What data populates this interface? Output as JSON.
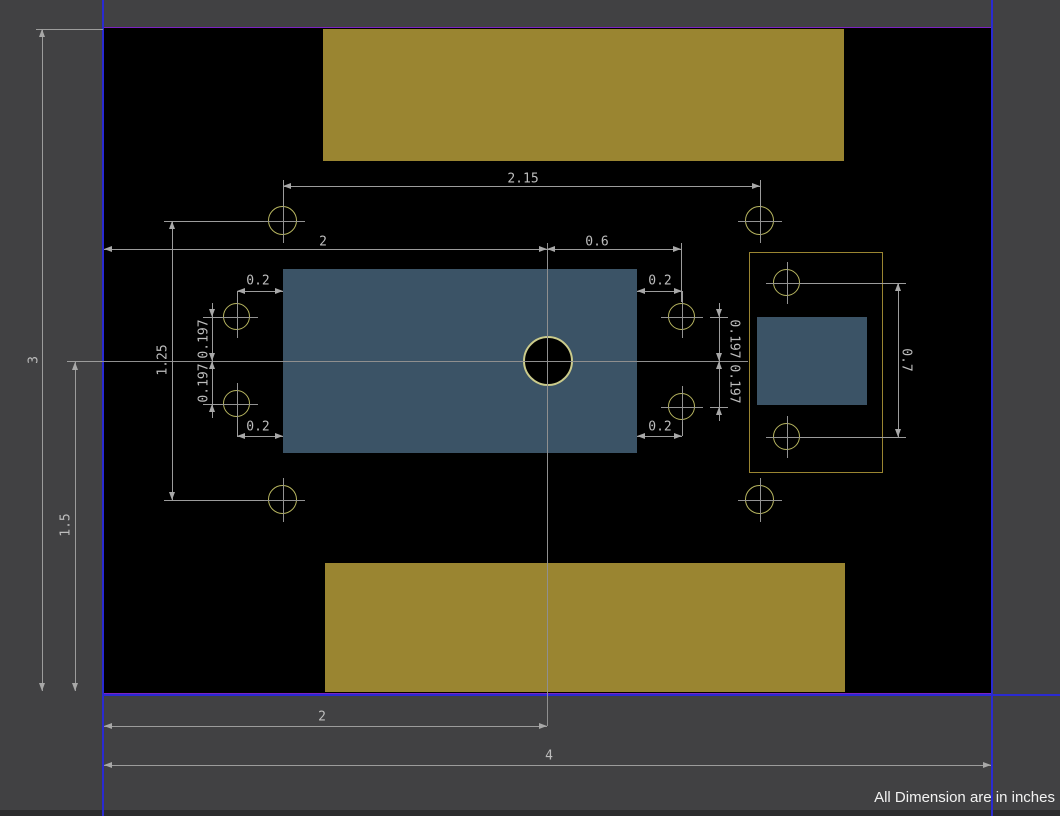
{
  "note": {
    "text": "All Dimension are in inches"
  },
  "drawing": {
    "units": "inches",
    "dims": {
      "top_hole_span": "2.15",
      "left_edge_to_center_top": "2",
      "center_to_inner_right": "0.6",
      "inset_top_left": "0.2",
      "inset_bottom_left": "0.2",
      "inset_top_right": "0.2",
      "inset_bottom_right": "0.2",
      "hole_offset_left_upper": "0.197",
      "hole_offset_left_lower": "0.197",
      "hole_offset_right_upper": "0.197",
      "hole_offset_right_lower": "0.197",
      "connector_hole_span": "0.7",
      "outer_hole_span_left": "1.25",
      "board_height": "3",
      "center_from_bottom": "1.5",
      "left_edge_to_center_bottom": "2",
      "board_width": "4"
    },
    "colors": {
      "background": "#414143",
      "board_fill": "#000000",
      "board_outline": "#7d22c3",
      "sheet_guide": "#2a2ad2",
      "pad": "#9a8531",
      "component": "#3b5366",
      "hole_ring": "#b6b45f",
      "dimension": "#9c9c9c"
    }
  }
}
